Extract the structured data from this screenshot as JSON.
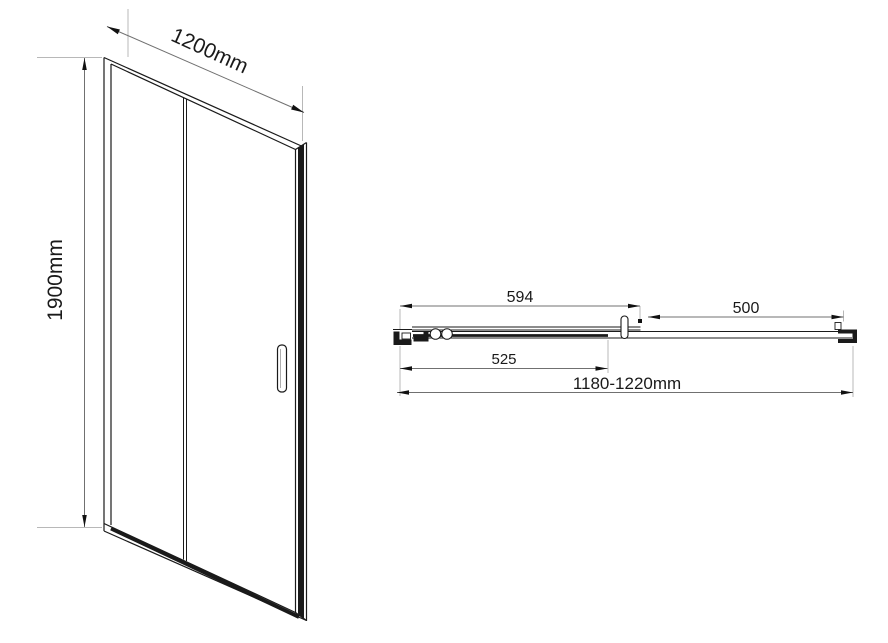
{
  "front_view": {
    "width_label": "1200mm",
    "height_label": "1900mm"
  },
  "plan_view": {
    "fixed_panel_width": "594",
    "sliding_panel_width": "525",
    "opening_width": "500",
    "overall_width": "1180-1220mm"
  },
  "colors": {
    "line": "#1a1a1a",
    "dim_line": "#707070",
    "ext_line": "#b8b8b8",
    "arrow": "#111111",
    "background": "#ffffff"
  }
}
